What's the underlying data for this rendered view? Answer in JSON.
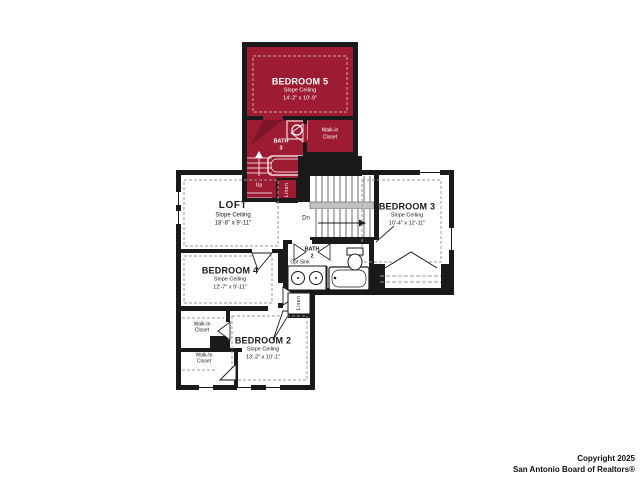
{
  "colors": {
    "wing_red": "#9e1c33",
    "wing_red_dark": "#7f152a",
    "wall_black": "#1a1a1a",
    "railing_gray": "#c2c2c2"
  },
  "rooms": {
    "bedroom5": {
      "name": "BEDROOM 5",
      "ceiling": "Slope Ceiling",
      "dims": "14'-2\" x 10'-9\""
    },
    "bath3": {
      "name": "BATH",
      "number": "3"
    },
    "walkin_closet_upper": {
      "line1": "Walk-in",
      "line2": "Closet"
    },
    "loft": {
      "name": "LOFT",
      "ceiling": "Slope Ceiling",
      "dims": "18'-8\" x 9'-11\""
    },
    "bedroom3": {
      "name": "BEDROOM 3",
      "ceiling": "Slope Ceiling",
      "dims": "10'-4\" x 12'-11\""
    },
    "bedroom4": {
      "name": "BEDROOM 4",
      "ceiling": "Slope Ceiling",
      "dims": "12'-7\" x 9'-11\""
    },
    "bath2": {
      "name": "BATH",
      "number": "2",
      "opt_sink": "Opt Sink"
    },
    "bedroom2": {
      "name": "BEDROOM 2",
      "ceiling": "Slope Ceiling",
      "dims": "13'-2\" x 10'-1\""
    },
    "walkin_closet_1": {
      "line1": "Walk-In",
      "line2": "Closet"
    },
    "walkin_closet_2": {
      "line1": "Walk-In",
      "line2": "Closet"
    }
  },
  "stairs": {
    "up": "Up",
    "down": "Dn"
  },
  "closets": {
    "linen_upper": "Linen",
    "linen_lower": "Linen"
  },
  "footer": {
    "copyright_line1": "Copyright 2025",
    "copyright_line2": "San Antonio Board of Realtors®"
  }
}
